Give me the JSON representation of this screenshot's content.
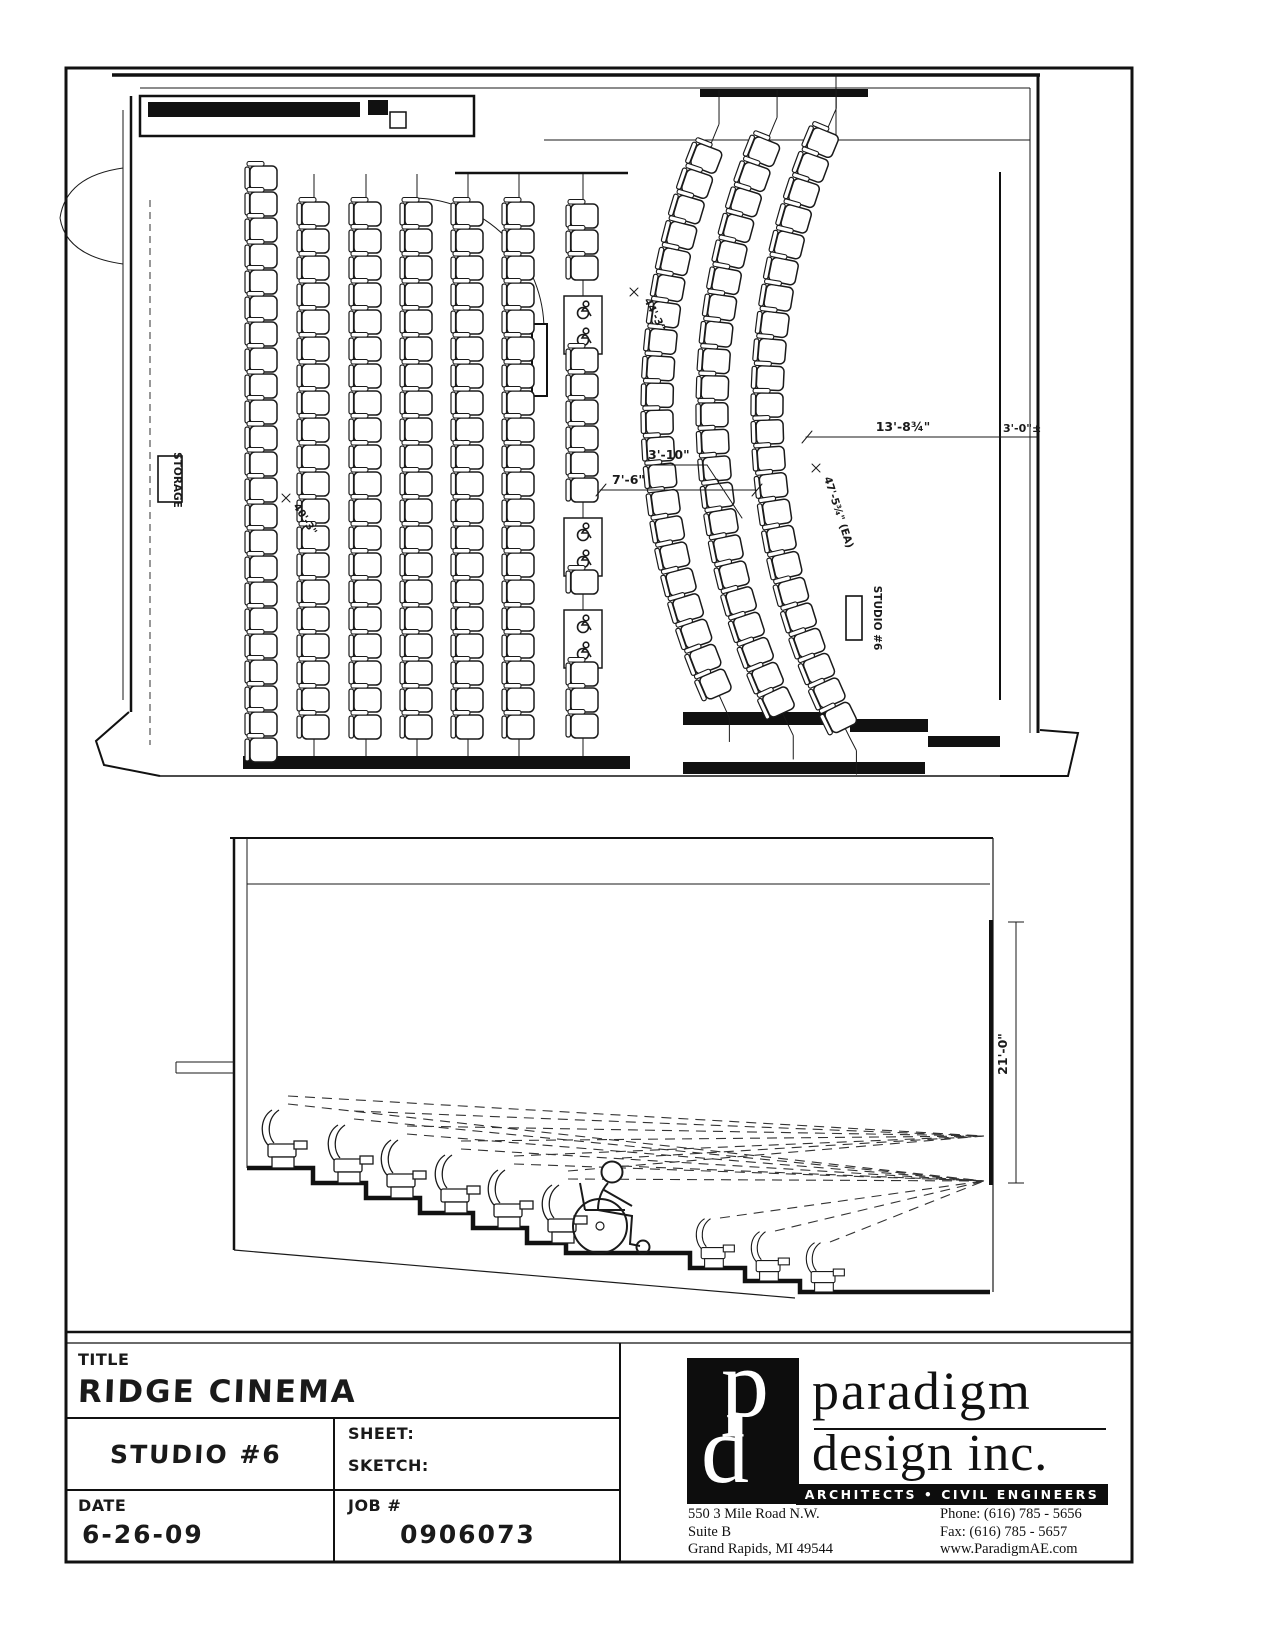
{
  "sheet": {
    "ink": "#1a1a1a",
    "paper": "#ffffff"
  },
  "plan": {
    "storage_label": "STORAGE",
    "studio_label": "STUDIO #6",
    "dims": {
      "row_to_row": "3'-10\"",
      "row_to_curve": "7'-6\"",
      "curve_to_screen": "13'-8¾\"",
      "screen_to_wall": "3'-0\"±",
      "straight_row_length": "40'-3\"",
      "curve_radius_inner": "44'-3\"",
      "curve_radius_outer": "47'-5¾\" (EA)"
    },
    "straight_rows": {
      "seat_counts": [
        23,
        20,
        20,
        20,
        20,
        20
      ]
    },
    "accessible_row": {
      "seat_segments": [
        3,
        6,
        1,
        3
      ],
      "wheelchair_boxes": 3,
      "wheelchair_spaces_per_box": 2
    },
    "curved_rows": {
      "seat_counts": [
        21,
        22,
        23
      ]
    }
  },
  "section": {
    "screen_height": "21'-0\"",
    "stepped_seats": 6,
    "floor_seats": 3,
    "has_wheelchair_position": true
  },
  "titleblock": {
    "title_label": "TITLE",
    "title": "RIDGE CINEMA",
    "studio": "STUDIO #6",
    "sheet_label": "SHEET:",
    "sketch_label": "SKETCH:",
    "date_label": "DATE",
    "date": "6-26-09",
    "job_label": "JOB #",
    "job_number": "0906073"
  },
  "firm": {
    "monogram_p": "p",
    "monogram_d": "d",
    "name_line1": "paradigm",
    "name_line2": "design inc.",
    "tagline": "ARCHITECTS • CIVIL ENGINEERS",
    "address": [
      "550 3 Mile Road N.W.",
      "Suite B",
      "Grand Rapids, MI  49544"
    ],
    "contact": [
      "Phone: (616) 785 - 5656",
      "Fax: (616) 785 - 5657",
      "www.ParadigmAE.com"
    ]
  }
}
